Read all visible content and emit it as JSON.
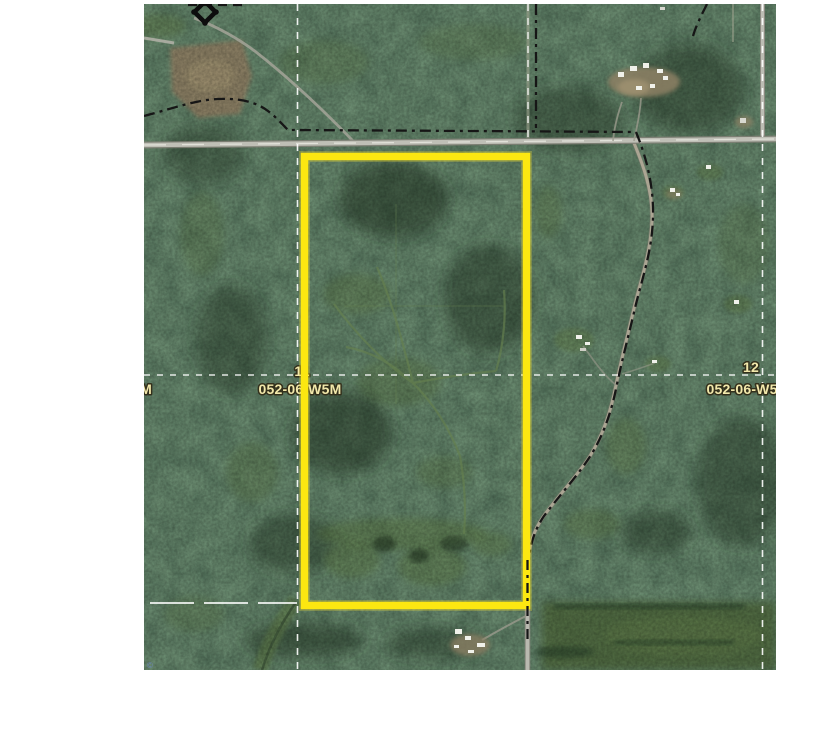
{
  "map": {
    "alt": "Aerial satellite map with highlighted land parcel boundary",
    "labels": {
      "left_section_number": "11",
      "left_township": "052-06-W5M",
      "right_section_number": "12",
      "right_township": "052-06-W5M",
      "west_edge_partial": "W5M",
      "copyright_mark": "©"
    },
    "icons": {
      "survey_marker": "diamond-survey-marker"
    },
    "colors": {
      "parcel_boundary": "#fce711",
      "label_fill": "#f2e8ab",
      "label_outline": "#33301c",
      "section_line": "#ffffff",
      "boundary_dashdot": "#161616",
      "road": "#bfbfb6",
      "forest_dark": "#1d2f1f",
      "forest_light": "#5b7744",
      "field_brown": "#8e8266"
    }
  }
}
